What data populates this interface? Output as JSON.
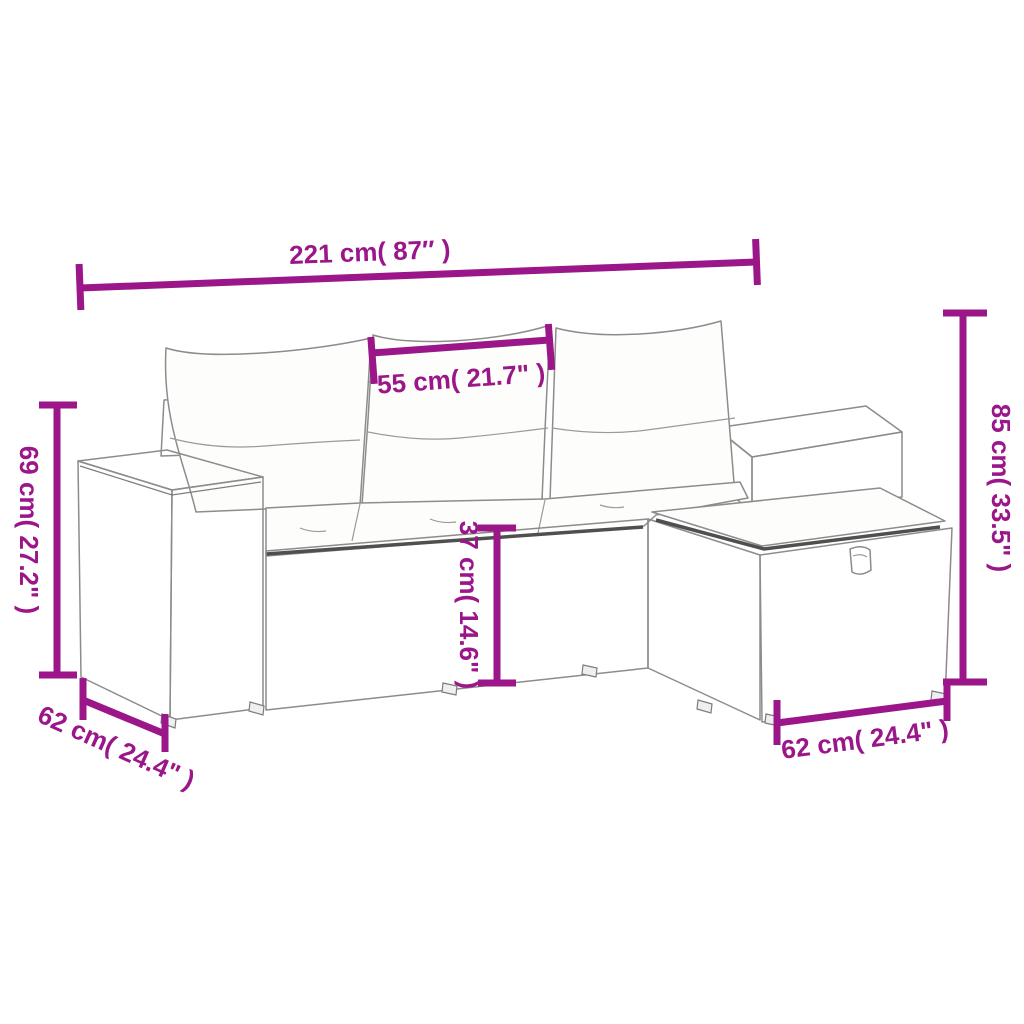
{
  "image": {
    "title": "Rattan garden sofa set with ottoman and cushions — dimension diagram",
    "background": "#ffffff",
    "accent_color": "#9a1689",
    "outline_color": "#8c8c8c"
  },
  "dims": {
    "overall_width": "221 cm( 87″ )",
    "seat_width": "55 cm( 21.7\" )",
    "arm_height": "69 cm( 27.2\" )",
    "seat_height": "37 cm( 14.6\" )",
    "back_height": "85 cm( 33.5\" )",
    "arm_depth": "62 cm( 24.4\" )",
    "ottoman_width": "62 cm( 24.4\" )"
  }
}
